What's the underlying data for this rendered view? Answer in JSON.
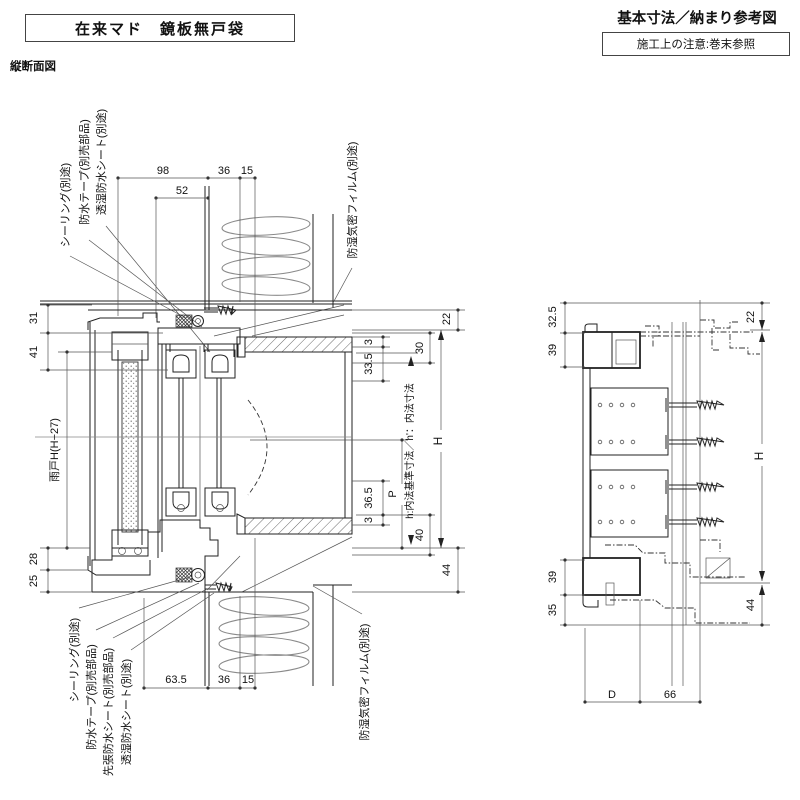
{
  "header": {
    "title": "在来マド　鏡板無戸袋",
    "subtitle": "基本寸法／納まり参考図",
    "note": "施工上の注意:巻末参照",
    "view_label": "縦断面図"
  },
  "left": {
    "dims_top": {
      "d98": "98",
      "d52": "52",
      "d36": "36",
      "d15": "15"
    },
    "dims_left": {
      "d31": "31",
      "d41": "41",
      "d28": "28",
      "d25": "25",
      "amado": "雨戸H(H−27)"
    },
    "dims_right": {
      "d22": "22",
      "d30": "30",
      "d3a": "3",
      "d33_5": "33.5",
      "uchinori": "h:内法基準寸法／h'：内法寸法",
      "dP": "P",
      "d36_5": "36.5",
      "d3b": "3",
      "d40": "40",
      "dH": "H",
      "d44": "44"
    },
    "dims_bottom": {
      "d63_5": "63.5",
      "d36": "36",
      "d15": "15"
    },
    "callouts_top": {
      "sealing": "シーリング(別途)",
      "tape": "防水テープ(別売部品)",
      "sheet": "透湿防水シート(別途)",
      "film": "防湿気密フィルム(別途)"
    },
    "callouts_bottom": {
      "sealing": "シーリング(別途)",
      "tape": "防水テープ(別売部品)",
      "sakibari": "先張防水シート(別売部品)",
      "sheet": "透湿防水シート(別途)",
      "film": "防湿気密フィルム(別途)"
    }
  },
  "right": {
    "dims": {
      "d32_5": "32.5",
      "d39a": "39",
      "d22": "22",
      "dH": "H",
      "d39b": "39",
      "d35": "35",
      "d44": "44",
      "dD": "D",
      "d66": "66"
    }
  },
  "colors": {
    "line": "#222222",
    "dimline": "#555555",
    "insulation": "#8a8a8a"
  }
}
